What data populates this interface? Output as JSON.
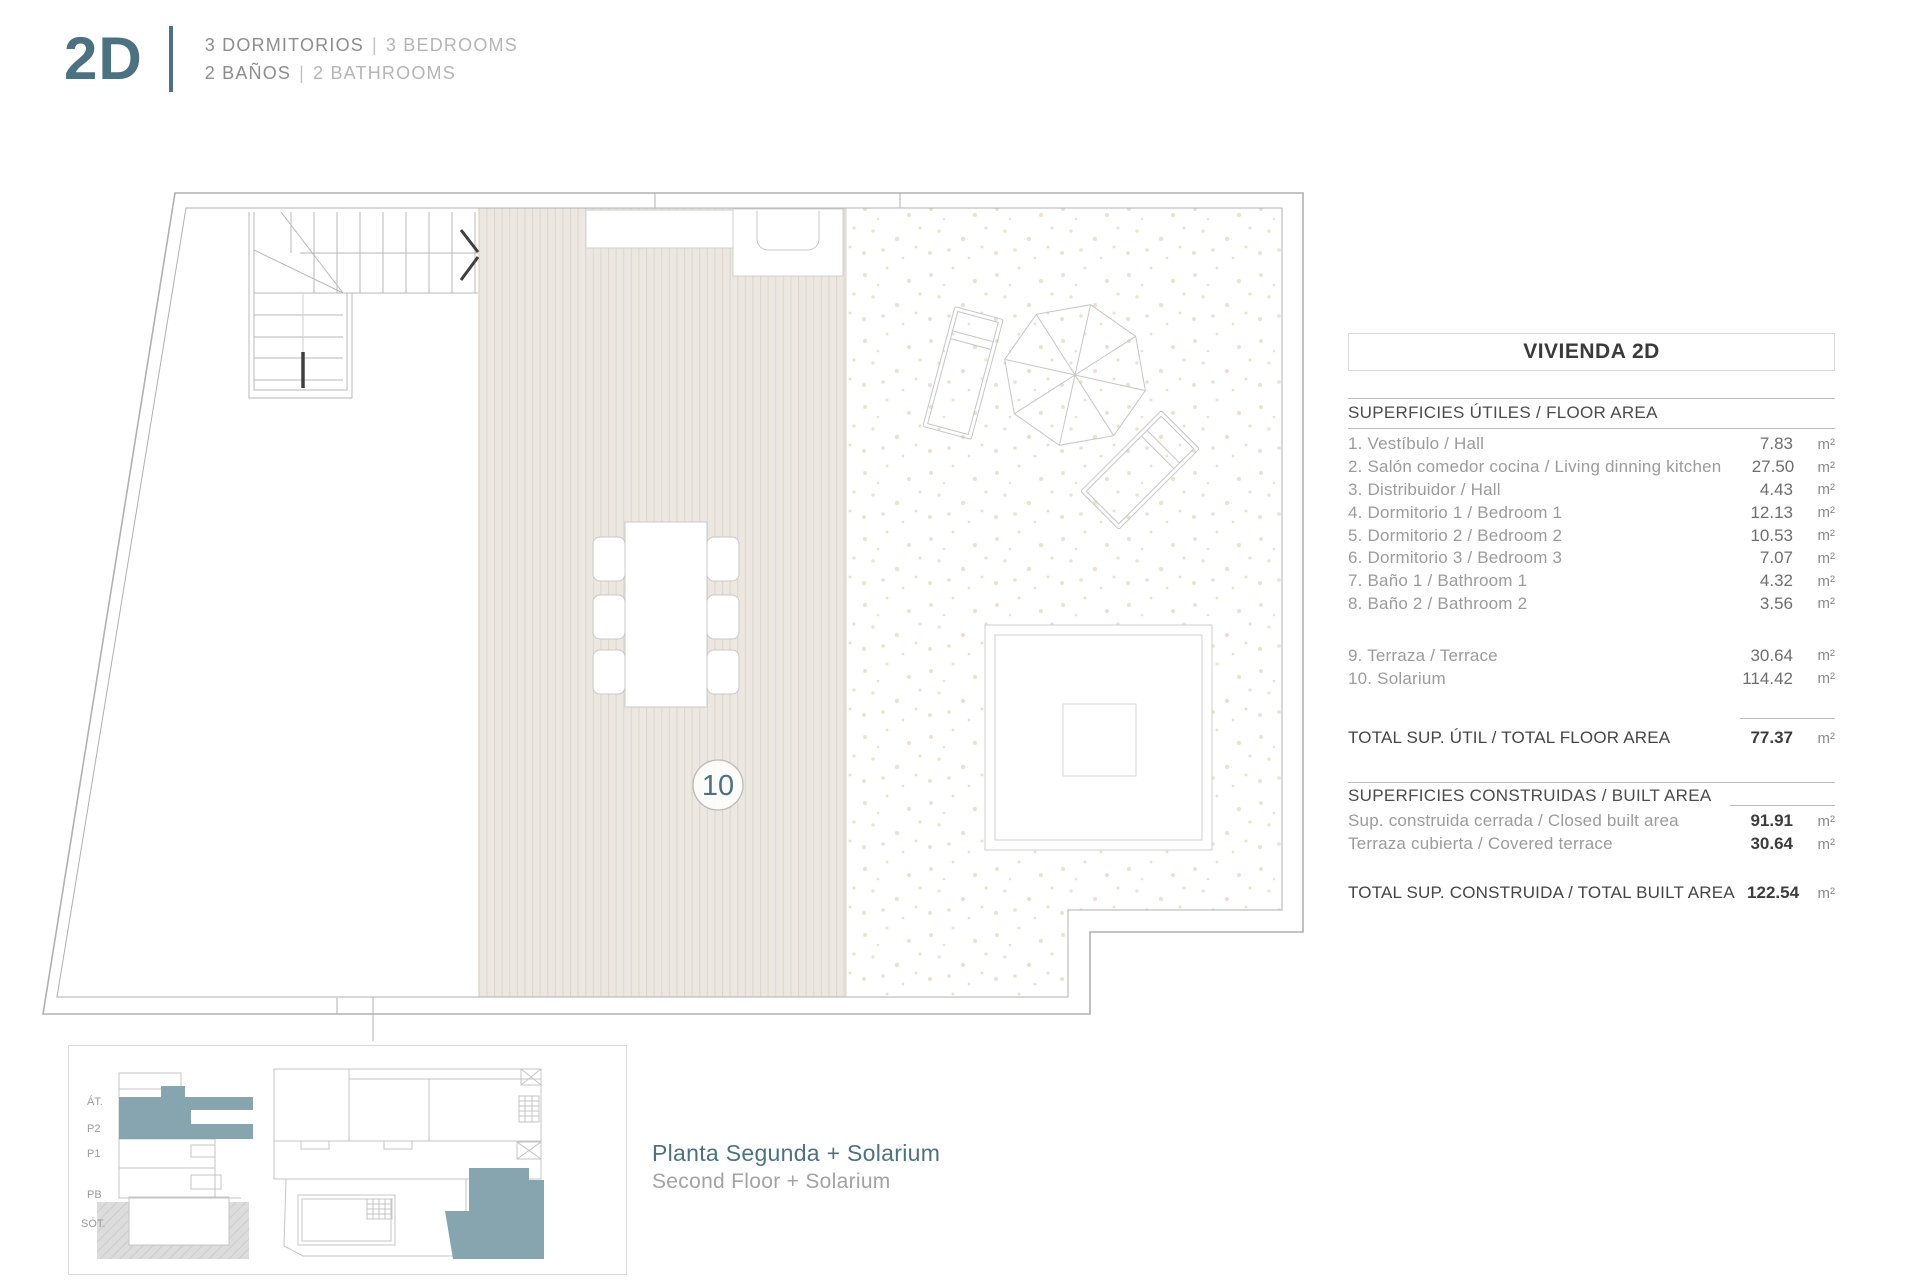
{
  "header": {
    "unit": "2D",
    "separator": "|",
    "line1": {
      "es": "3 DORMITORIOS",
      "en": "3 BEDROOMS"
    },
    "line2": {
      "es": "2 BAÑOS",
      "en": "2 BATHROOMS"
    }
  },
  "plan": {
    "room_label": "10"
  },
  "areas_table": {
    "title": "VIVIENDA 2D",
    "unit": "m²",
    "floor_area": {
      "header": "SUPERFICIES ÚTILES / FLOOR AREA",
      "rows": [
        {
          "label": "1. Vestíbulo / Hall",
          "value": "7.83"
        },
        {
          "label": "2. Salón comedor cocina / Living dinning kitchen",
          "value": "27.50"
        },
        {
          "label": "3. Distribuidor / Hall",
          "value": "4.43"
        },
        {
          "label": "4. Dormitorio 1 / Bedroom 1",
          "value": "12.13"
        },
        {
          "label": "5. Dormitorio 2 / Bedroom 2",
          "value": "10.53"
        },
        {
          "label": "6. Dormitorio 3 / Bedroom 3",
          "value": "7.07"
        },
        {
          "label": "7. Baño 1 / Bathroom 1",
          "value": "4.32"
        },
        {
          "label": "8. Baño 2 / Bathroom 2",
          "value": "3.56"
        },
        {
          "label": "9. Terraza / Terrace",
          "value": "30.64"
        },
        {
          "label": "10. Solarium",
          "value": "114.42"
        }
      ]
    },
    "total_floor": {
      "label": "TOTAL SUP. ÚTIL / TOTAL FLOOR AREA",
      "value": "77.37"
    },
    "built_area": {
      "header": "SUPERFICIES CONSTRUIDAS / BUILT AREA",
      "rows": [
        {
          "label": "Sup. construida cerrada / Closed built area",
          "value": "91.91"
        },
        {
          "label": "Terraza cubierta / Covered terrace",
          "value": "30.64"
        }
      ]
    },
    "total_built": {
      "label": "TOTAL SUP. CONSTRUIDA / TOTAL BUILT AREA",
      "value": "122.54"
    }
  },
  "key_plan": {
    "floor_labels": [
      "ÁT.",
      "P2",
      "P1",
      "PB",
      "SÓT."
    ]
  },
  "caption": {
    "es": "Planta Segunda + Solarium",
    "en": "Second Floor + Solarium"
  },
  "colors": {
    "accent_teal": "#4c7282",
    "teal_fill": "#86a5af",
    "deck": "#ece7e1",
    "line": "#b0b0b0"
  }
}
